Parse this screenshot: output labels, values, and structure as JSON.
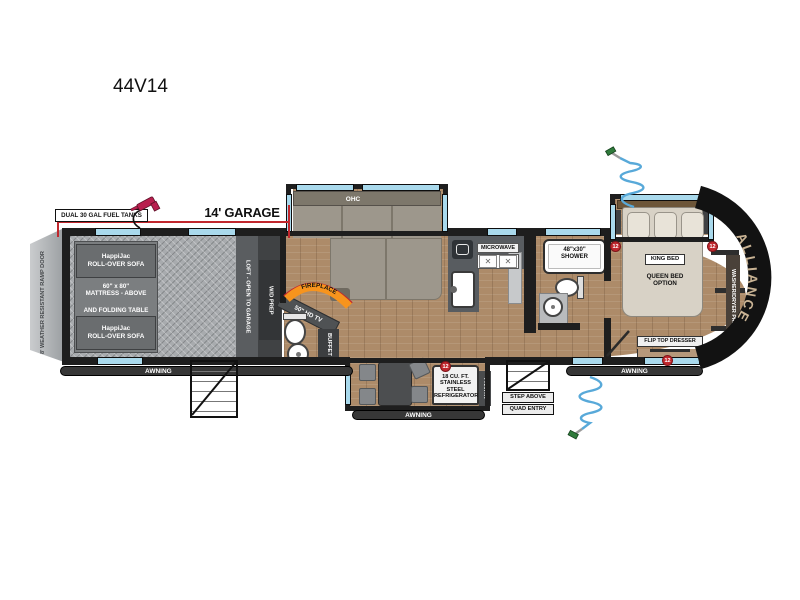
{
  "model": "44V14",
  "dimension": {
    "garage_length": "14' GARAGE",
    "fuel": "DUAL 30 GAL FUEL TANKS"
  },
  "ramp": {
    "label": "8' WEATHER RESISTANT RAMP DOOR"
  },
  "garage": {
    "sofa1": [
      "HappiJac",
      "ROLL-OVER SOFA"
    ],
    "mattress": [
      "60\" x 80\"",
      "MATTRESS - ABOVE"
    ],
    "folding_table": "AND FOLDING TABLE",
    "sofa2": [
      "HappiJac",
      "ROLL-OVER SOFA"
    ],
    "loft": "LOFT - OPEN TO GARAGE",
    "wd_prep": "W/D PREP"
  },
  "living": {
    "ohc": "OHC",
    "fireplace": "FIREPLACE",
    "tv": "50\" HD TV",
    "buffet": "BUFFET"
  },
  "kitchen": {
    "microwave": "MICROWAVE",
    "refrigerator": [
      "18 CU. FT.",
      "STAINLESS STEEL",
      "REFRIGERATOR"
    ],
    "pantry": "PANTRY"
  },
  "bath": {
    "shower": [
      "48\"x30\"",
      "SHOWER"
    ]
  },
  "bedroom": {
    "king_bed": "KING BED",
    "queen_option": [
      "QUEEN BED",
      "OPTION"
    ],
    "dresser": "FLIP TOP DRESSER",
    "wd_prep": "WASHER/DRYER PREP"
  },
  "entry": {
    "step_above": "STEP ABOVE",
    "quad_entry": "QUAD ENTRY"
  },
  "exterior": {
    "awning": "AWNING",
    "brand": "ALLIANCE"
  },
  "badges": {
    "twelve_volt": "12"
  },
  "colors": {
    "red": "#c1272d",
    "window_blue": "#a9d9ec",
    "accent_orange": "#f7941d",
    "wood": "#ad8b69",
    "front_cap": "#121212",
    "brand_text": "#c9b394"
  }
}
